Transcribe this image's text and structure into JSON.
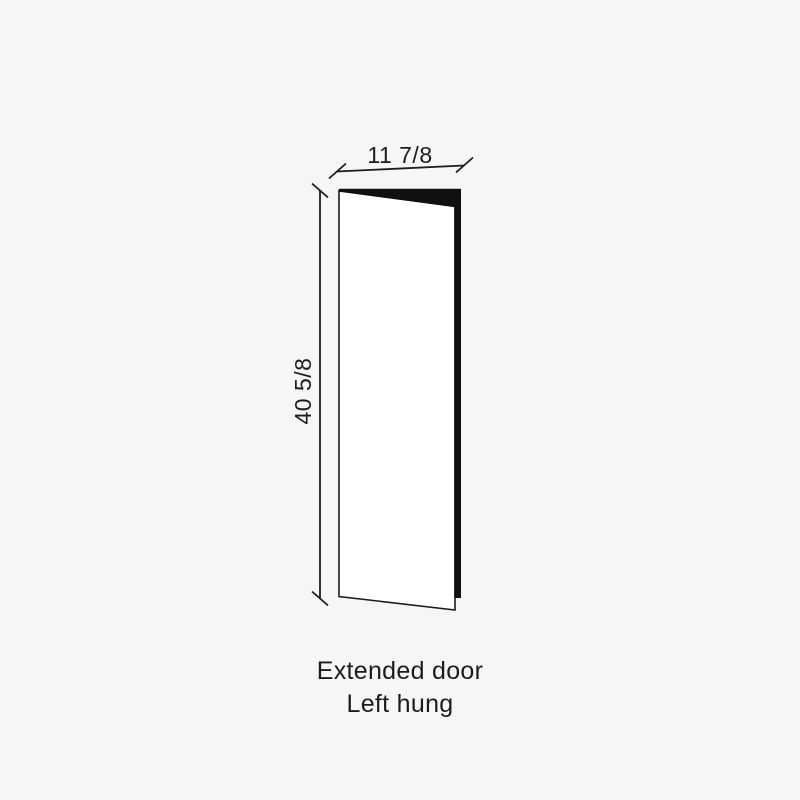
{
  "diagram": {
    "width_dimension": {
      "label": "11 7/8"
    },
    "height_dimension": {
      "label": "40 5/8"
    },
    "caption": {
      "line1": "Extended door",
      "line2": "Left hung"
    },
    "colors": {
      "background": "#f6f6f6",
      "ink": "#1c1c1c",
      "door_face": "#ffffff",
      "door_edge": "#101010"
    }
  }
}
